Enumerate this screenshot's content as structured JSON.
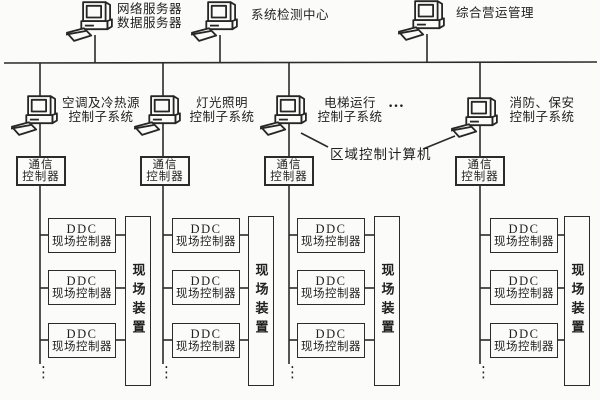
{
  "colors": {
    "ink": "#2b2b2b",
    "background": "#fbfbf9"
  },
  "top_nodes": [
    {
      "line1": "网络服务器",
      "line2": "数据服务器"
    },
    {
      "line1": "系统检测中心"
    },
    {
      "line1": "综合营运管理"
    }
  ],
  "subsystems": [
    {
      "line1": "空调及冷热源",
      "line2": "控制子系统"
    },
    {
      "line1": "灯光照明",
      "line2": "控制子系统"
    },
    {
      "line1": "电梯运行",
      "line2": "控制子系统"
    },
    {
      "line1": "消防、保安",
      "line2": "控制子系统"
    }
  ],
  "area_controller_label": "区域控制计算机",
  "comm_controller": {
    "line1": "通信",
    "line2": "控制器"
  },
  "ddc_controller": {
    "line1": "DDC",
    "line2": "现场控制器"
  },
  "field_device_label": "现场装置",
  "h_ellipsis": "…",
  "v_ellipsis": "⋮"
}
